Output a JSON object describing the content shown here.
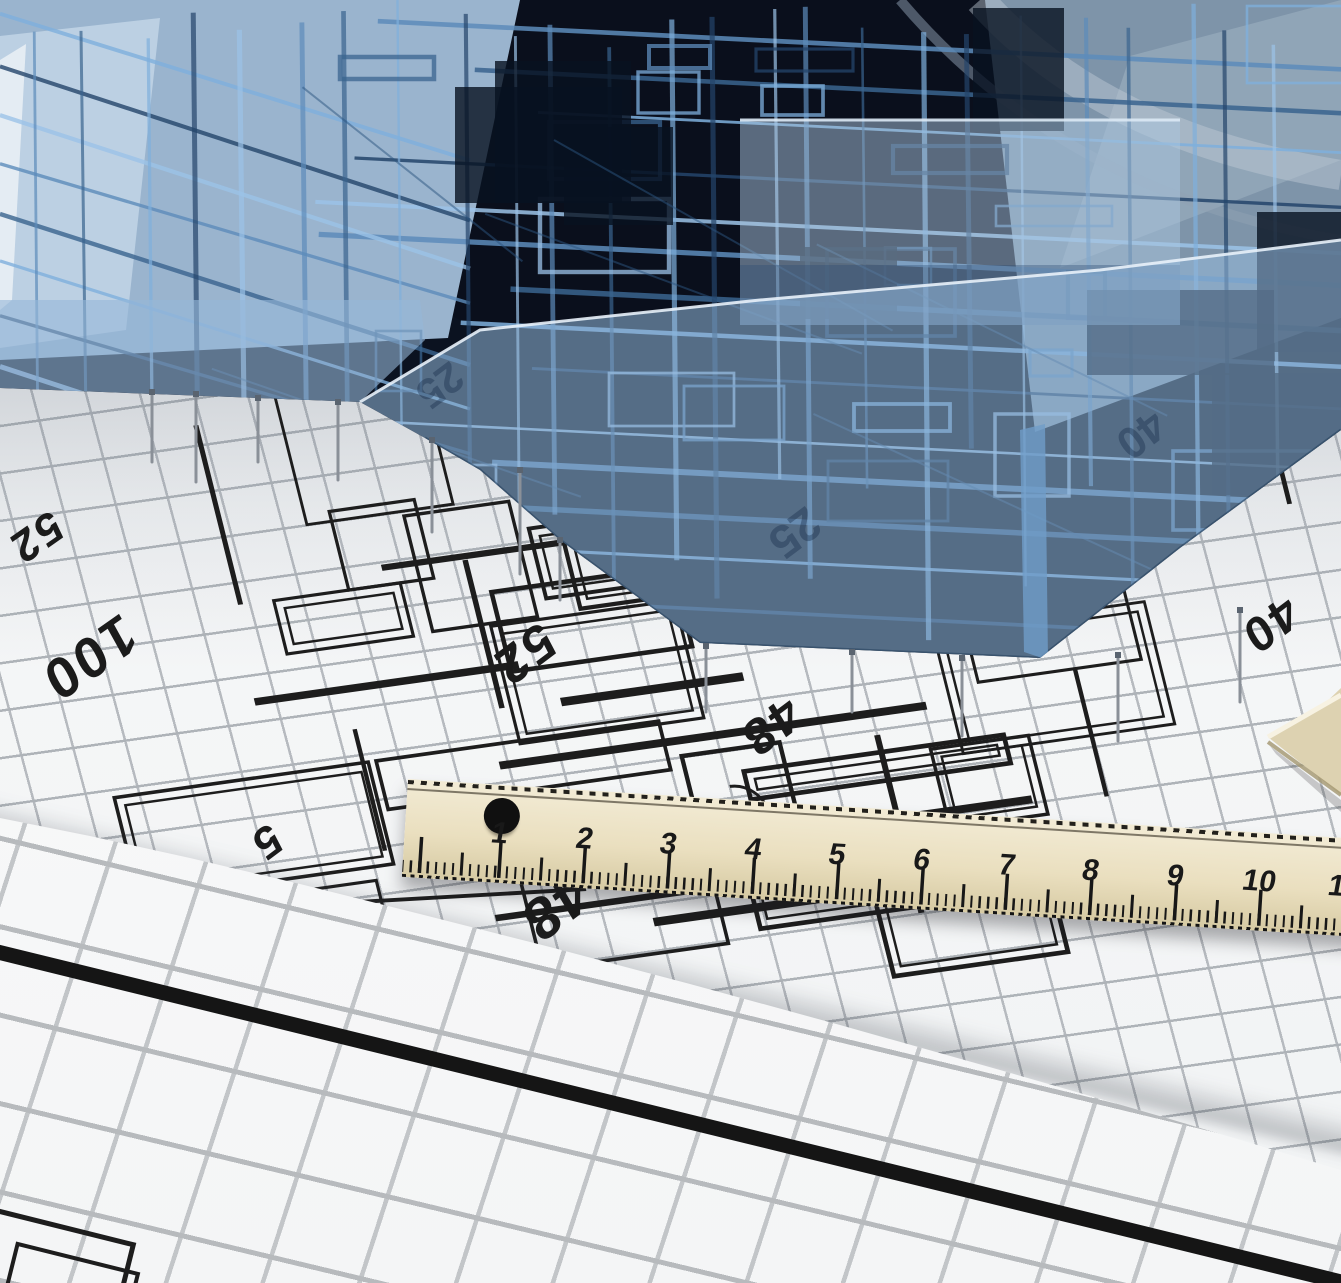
{
  "blueprint": {
    "annotations": [
      {
        "label": "100"
      },
      {
        "label": "52"
      },
      {
        "label": "52"
      },
      {
        "label": "48"
      },
      {
        "label": "40"
      },
      {
        "label": "5"
      },
      {
        "label": "48"
      }
    ]
  },
  "glass": {
    "annotations": [
      {
        "label": "25"
      },
      {
        "label": "25"
      },
      {
        "label": "40"
      }
    ]
  },
  "ruler": {
    "marks": [
      "1",
      "2",
      "3",
      "4",
      "5",
      "6",
      "7",
      "8",
      "9",
      "10",
      "11"
    ]
  },
  "colors": {
    "wireframe_blue": "#4a7fb5",
    "wireframe_light": "#7fb0dd",
    "glass_blue": "#a8c4dd",
    "dark_interior": "#0b1220",
    "plan_line": "#1d1d1d",
    "grid_grey": "#b4b8bc",
    "ruler_wood": "#e9e0c4",
    "paper_white": "#f8f9f9"
  }
}
